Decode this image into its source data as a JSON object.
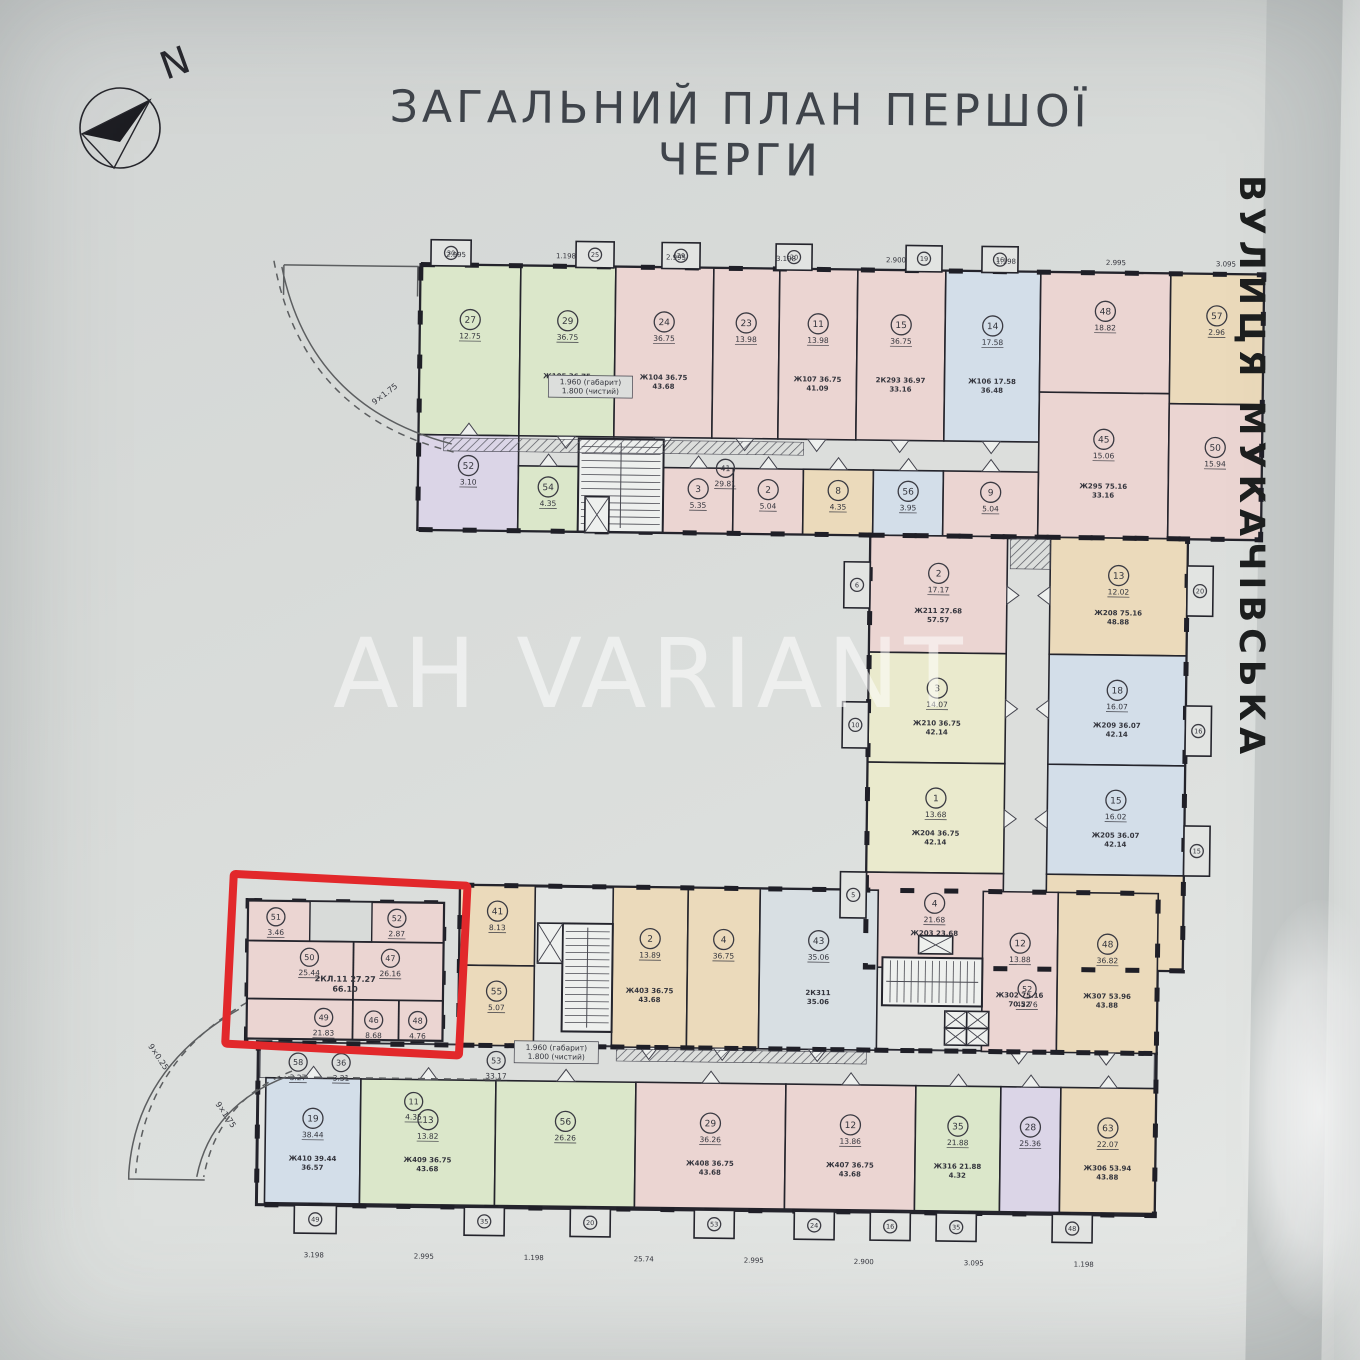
{
  "title": "ЗАГАЛЬНИЙ ПЛАН ПЕРШОЇ ЧЕРГИ",
  "compass": {
    "label": "N"
  },
  "street": {
    "label": "ВУЛИЦЯ МУКАЧІВСЬКА"
  },
  "watermark": {
    "label": "AH VARIANT"
  },
  "colors": {
    "paper": "#d8dbd9",
    "interior": "#e2e4e2",
    "corridor": "#dcdedc",
    "core": "#eef0ee",
    "wall": "#24242c",
    "line": "#43434d",
    "red": "#e2282b",
    "dim": "#5a5c60",
    "g": "#dbe7ca",
    "p": "#ebd5d2",
    "t": "#ebdabb",
    "b": "#d3dee9",
    "v": "#dbd5e7",
    "y": "#eaeacd",
    "s": "#d8dfe3"
  },
  "highlight": {
    "apartment_label": "2КЛ.11 27.27",
    "apartment_area": "66.10",
    "body": [
      250,
      906,
      196,
      138
    ],
    "notch": [
      312,
      906,
      62,
      40
    ],
    "inner_lines": [
      [
        356,
        946,
        356,
        1004
      ],
      [
        250,
        1004,
        446,
        1004
      ],
      [
        356,
        1004,
        356,
        1044
      ],
      [
        402,
        1004,
        402,
        1044
      ],
      [
        250,
        946,
        446,
        946
      ]
    ],
    "rooms": [
      [
        312,
        962,
        "50",
        "25.44"
      ],
      [
        393,
        962,
        "47",
        "26.16"
      ],
      [
        327,
        1022,
        "49",
        "21.83"
      ],
      [
        377,
        1024,
        "46",
        "8.68"
      ],
      [
        421,
        1024,
        "48",
        "4.76"
      ],
      [
        278,
        922,
        "51",
        "3.46"
      ],
      [
        399,
        922,
        "52",
        "2.87"
      ]
    ],
    "label_pos": [
      348,
      986
    ],
    "red_box": [
      232,
      884,
      234,
      170
    ],
    "red_box_rotation": 2.2
  },
  "plan": {
    "rotation": 0.7,
    "wings": [
      [
        415,
        268,
        843,
        265
      ],
      [
        868,
        533,
        317,
        432
      ],
      [
        462,
        888,
        698,
        160
      ],
      [
        262,
        1048,
        898,
        162
      ]
    ],
    "corridors": [
      [
        417,
        438,
        839,
        30
      ],
      [
        1005,
        535,
        43,
        428
      ],
      [
        264,
        1048,
        894,
        35
      ]
    ],
    "units": [
      [
        415,
        268,
        100,
        170,
        "g",
        "27",
        "12.75",
        0,
        "b"
      ],
      [
        515,
        268,
        95,
        170,
        "g",
        "29",
        "36.75",
        [
          "Ж105 36.75",
          "43.68"
        ],
        "b"
      ],
      [
        610,
        268,
        98,
        170,
        "p",
        "24",
        "36.75",
        [
          "Ж104 36.75",
          "43.68"
        ],
        "b"
      ],
      [
        708,
        268,
        66,
        170,
        "p",
        "23",
        "13.98",
        0,
        "b"
      ],
      [
        774,
        268,
        78,
        170,
        "p",
        "11",
        "13.98",
        [
          "Ж107 36.75",
          "41.09"
        ],
        "b"
      ],
      [
        852,
        268,
        88,
        170,
        "p",
        "15",
        "36.75",
        [
          "2К293 36.97",
          "33.16"
        ],
        "b"
      ],
      [
        940,
        268,
        95,
        170,
        "b",
        "14",
        "17.58",
        [
          "Ж106 17.58",
          "36.48"
        ],
        "b"
      ],
      [
        1035,
        268,
        130,
        120,
        "p",
        "48",
        "18.82",
        0,
        0
      ],
      [
        1035,
        388,
        130,
        145,
        "p",
        "45",
        "15.06",
        [
          "Ж295 75.16",
          "33.16"
        ],
        0
      ],
      [
        1165,
        268,
        93,
        130,
        "t",
        "57",
        "2.96",
        0,
        0
      ],
      [
        1165,
        398,
        93,
        135,
        "p",
        "50",
        "15.94",
        0,
        0
      ],
      [
        415,
        438,
        100,
        95,
        "v",
        "52",
        "3.10",
        0,
        "t"
      ],
      [
        515,
        468,
        60,
        65,
        "g",
        "54",
        "4.35",
        0,
        "t"
      ],
      [
        660,
        468,
        70,
        65,
        "p",
        "3",
        "5.35",
        0,
        "t"
      ],
      [
        730,
        468,
        70,
        65,
        "p",
        "2",
        "5.04",
        0,
        "t"
      ],
      [
        800,
        468,
        70,
        65,
        "t",
        "8",
        "4.35",
        0,
        "t"
      ],
      [
        870,
        468,
        70,
        65,
        "b",
        "56",
        "3.95",
        0,
        "t"
      ],
      [
        940,
        468,
        95,
        65,
        "p",
        "9",
        "5.04",
        0,
        "t"
      ],
      [
        868,
        533,
        137,
        117,
        "p",
        "2",
        "17.17",
        [
          "Ж211 27.68",
          "57.57"
        ],
        "r"
      ],
      [
        868,
        650,
        137,
        110,
        "y",
        "3",
        "14.07",
        [
          "Ж210 36.75",
          "42.14"
        ],
        "r"
      ],
      [
        868,
        760,
        137,
        110,
        "y",
        "1",
        "13.68",
        [
          "Ж204 36.75",
          "42.14"
        ],
        "r"
      ],
      [
        868,
        870,
        137,
        95,
        "p",
        "4",
        "21.68",
        [
          "Ж203 23.68",
          "32.52"
        ],
        "r"
      ],
      [
        1048,
        533,
        137,
        117,
        "t",
        "13",
        "12.02",
        [
          "Ж208 75.16",
          "48.88"
        ],
        "l"
      ],
      [
        1048,
        650,
        137,
        110,
        "b",
        "18",
        "16.07",
        [
          "Ж209 36.07",
          "42.14"
        ],
        "l"
      ],
      [
        1048,
        760,
        137,
        110,
        "b",
        "15",
        "16.02",
        [
          "Ж205 36.07",
          "42.14"
        ],
        "l"
      ],
      [
        1048,
        870,
        137,
        95,
        "t",
        "16",
        "16.02",
        [
          "Ж305 43.96",
          "42.96"
        ],
        "l"
      ],
      [
        462,
        888,
        75,
        80,
        "t",
        "41",
        "8.13",
        0,
        0
      ],
      [
        462,
        968,
        75,
        80,
        "t",
        "55",
        "5.07",
        0,
        0
      ],
      [
        615,
        888,
        75,
        160,
        "t",
        "2",
        "13.89",
        [
          "Ж403 36.75",
          "43.68"
        ],
        "b"
      ],
      [
        690,
        888,
        72,
        160,
        "t",
        "4",
        "36.75",
        0,
        "b"
      ],
      [
        762,
        888,
        118,
        160,
        "s",
        "43",
        "35.06",
        [
          "2К311",
          "35.06"
        ],
        "b"
      ],
      [
        985,
        888,
        75,
        160,
        "p",
        "12",
        "13.88",
        [
          "Ж302 75.16",
          "70.52"
        ],
        "b"
      ],
      [
        1060,
        888,
        100,
        160,
        "t",
        "48",
        "36.82",
        [
          "Ж307 53.96",
          "43.88"
        ],
        "b"
      ],
      [
        270,
        1083,
        95,
        125,
        "b",
        "19",
        "38.44",
        [
          "Ж410 39.44",
          "36.57"
        ],
        "t"
      ],
      [
        365,
        1083,
        135,
        125,
        "g",
        "13",
        "13.82",
        [
          "Ж409 36.75",
          "43.68"
        ],
        "t"
      ],
      [
        500,
        1083,
        140,
        125,
        "g",
        "56",
        "26.26",
        0,
        "t"
      ],
      [
        640,
        1083,
        150,
        125,
        "p",
        "29",
        "36.26",
        [
          "Ж408 36.75",
          "43.68"
        ],
        "t"
      ],
      [
        790,
        1083,
        130,
        125,
        "p",
        "12",
        "13.86",
        [
          "Ж407 36.75",
          "43.68"
        ],
        "t"
      ],
      [
        920,
        1083,
        85,
        125,
        "g",
        "35",
        "21.88",
        [
          "Ж316 21.88",
          "4.32"
        ],
        "t"
      ],
      [
        1005,
        1083,
        60,
        125,
        "v",
        "28",
        "25.36",
        0,
        "t"
      ],
      [
        1065,
        1083,
        95,
        125,
        "t",
        "63",
        "22.07",
        [
          "Ж306 53.94",
          "43.88"
        ],
        "t"
      ]
    ],
    "stubs": [
      [
        425,
        243,
        40,
        26,
        "30"
      ],
      [
        570,
        243,
        38,
        26,
        "25"
      ],
      [
        656,
        243,
        38,
        26,
        "29"
      ],
      [
        770,
        243,
        36,
        26,
        "20"
      ],
      [
        900,
        243,
        36,
        26,
        "19"
      ],
      [
        976,
        243,
        36,
        26,
        "16"
      ],
      [
        1185,
        560,
        26,
        50,
        "20"
      ],
      [
        1185,
        700,
        26,
        50,
        "16"
      ],
      [
        1185,
        820,
        26,
        50,
        "15"
      ],
      [
        842,
        560,
        26,
        46,
        "6"
      ],
      [
        842,
        700,
        26,
        46,
        "10"
      ],
      [
        842,
        870,
        26,
        46,
        "5"
      ],
      [
        300,
        1210,
        42,
        28,
        "49"
      ],
      [
        470,
        1210,
        40,
        28,
        "35"
      ],
      [
        576,
        1210,
        40,
        28,
        "20"
      ],
      [
        700,
        1210,
        40,
        28,
        "53"
      ],
      [
        800,
        1210,
        40,
        28,
        "24"
      ],
      [
        876,
        1210,
        40,
        28,
        "16"
      ],
      [
        942,
        1210,
        40,
        28,
        "35"
      ],
      [
        1058,
        1210,
        40,
        28,
        "48"
      ]
    ],
    "stairs": [
      [
        575,
        440,
        85,
        93,
        "v"
      ],
      [
        565,
        925,
        50,
        108,
        "v"
      ],
      [
        885,
        955,
        100,
        48,
        "h"
      ]
    ],
    "elevators": [
      [
        582,
        498,
        24,
        36
      ],
      [
        540,
        925,
        25,
        40
      ],
      [
        921,
        933,
        34,
        18
      ],
      [
        948,
        1008,
        22,
        17
      ],
      [
        970,
        1008,
        22,
        17
      ],
      [
        948,
        1025,
        22,
        17
      ],
      [
        970,
        1025,
        22,
        17
      ]
    ],
    "hatches": [
      [
        440,
        441,
        360,
        13
      ],
      [
        620,
        1050,
        250,
        12
      ],
      [
        1008,
        535,
        40,
        30
      ]
    ],
    "extras": [
      [
        302,
        1067,
        "58",
        "3.27"
      ],
      [
        345,
        1067,
        "36",
        "3.31"
      ],
      [
        418,
        1105,
        "11",
        "4.35"
      ],
      [
        722,
        468,
        "41",
        "29.81"
      ],
      [
        1030,
        985,
        "52",
        "42.76"
      ],
      [
        500,
        1063,
        "53",
        "33.17"
      ]
    ],
    "notes": [
      [
        586,
        386,
        [
          "1.960 (габарит)",
          "1.800 (чистий)"
        ]
      ],
      [
        560,
        1052,
        [
          "1.960 (габарит)",
          "1.800 (чистий)"
        ]
      ]
    ],
    "dims": [
      [
        450,
        260,
        "2.995"
      ],
      [
        560,
        260,
        "1.198"
      ],
      [
        670,
        260,
        "2.995"
      ],
      [
        780,
        260,
        "3.198"
      ],
      [
        890,
        260,
        "2.900"
      ],
      [
        1000,
        260,
        "1.198"
      ],
      [
        1110,
        260,
        "2.995"
      ],
      [
        1220,
        260,
        "3.095"
      ],
      [
        320,
        1262,
        "3.198"
      ],
      [
        430,
        1262,
        "2.995"
      ],
      [
        540,
        1262,
        "1.198"
      ],
      [
        650,
        1262,
        "25.74"
      ],
      [
        760,
        1262,
        "2.995"
      ],
      [
        870,
        1262,
        "2.900"
      ],
      [
        980,
        1262,
        "3.095"
      ],
      [
        1090,
        1262,
        "1.198"
      ]
    ],
    "arc_labels": [
      [
        382,
        400,
        "9×1.75",
        -38
      ],
      [
        160,
        1065,
        "9×0.25",
        55
      ],
      [
        228,
        1122,
        "9×1.75",
        55
      ]
    ],
    "arcs": [
      {
        "d": "M276,272 Q306,412 448,447",
        "dash": 0
      },
      {
        "d": "M268,266 Q298,420 450,455",
        "dash": 1
      },
      {
        "d": "M242,1015 Q140,1075 134,1180",
        "dash": 0
      },
      {
        "d": "M250,1008 Q148,1068 141,1180",
        "dash": 1
      },
      {
        "d": "M290,1082 Q215,1112 202,1183",
        "dash": 0
      },
      {
        "d": "M296,1076 Q222,1106 209,1183",
        "dash": 1
      },
      {
        "d": "M292,1082 L505,1082",
        "dash": 1
      },
      {
        "d": "M134,1180 L134,1186 L210,1186",
        "dash": 0
      },
      {
        "d": "M278,270 L412,270 L412,300",
        "dash": 0
      },
      {
        "d": "M278,270 L278,300",
        "dash": 0
      }
    ]
  }
}
